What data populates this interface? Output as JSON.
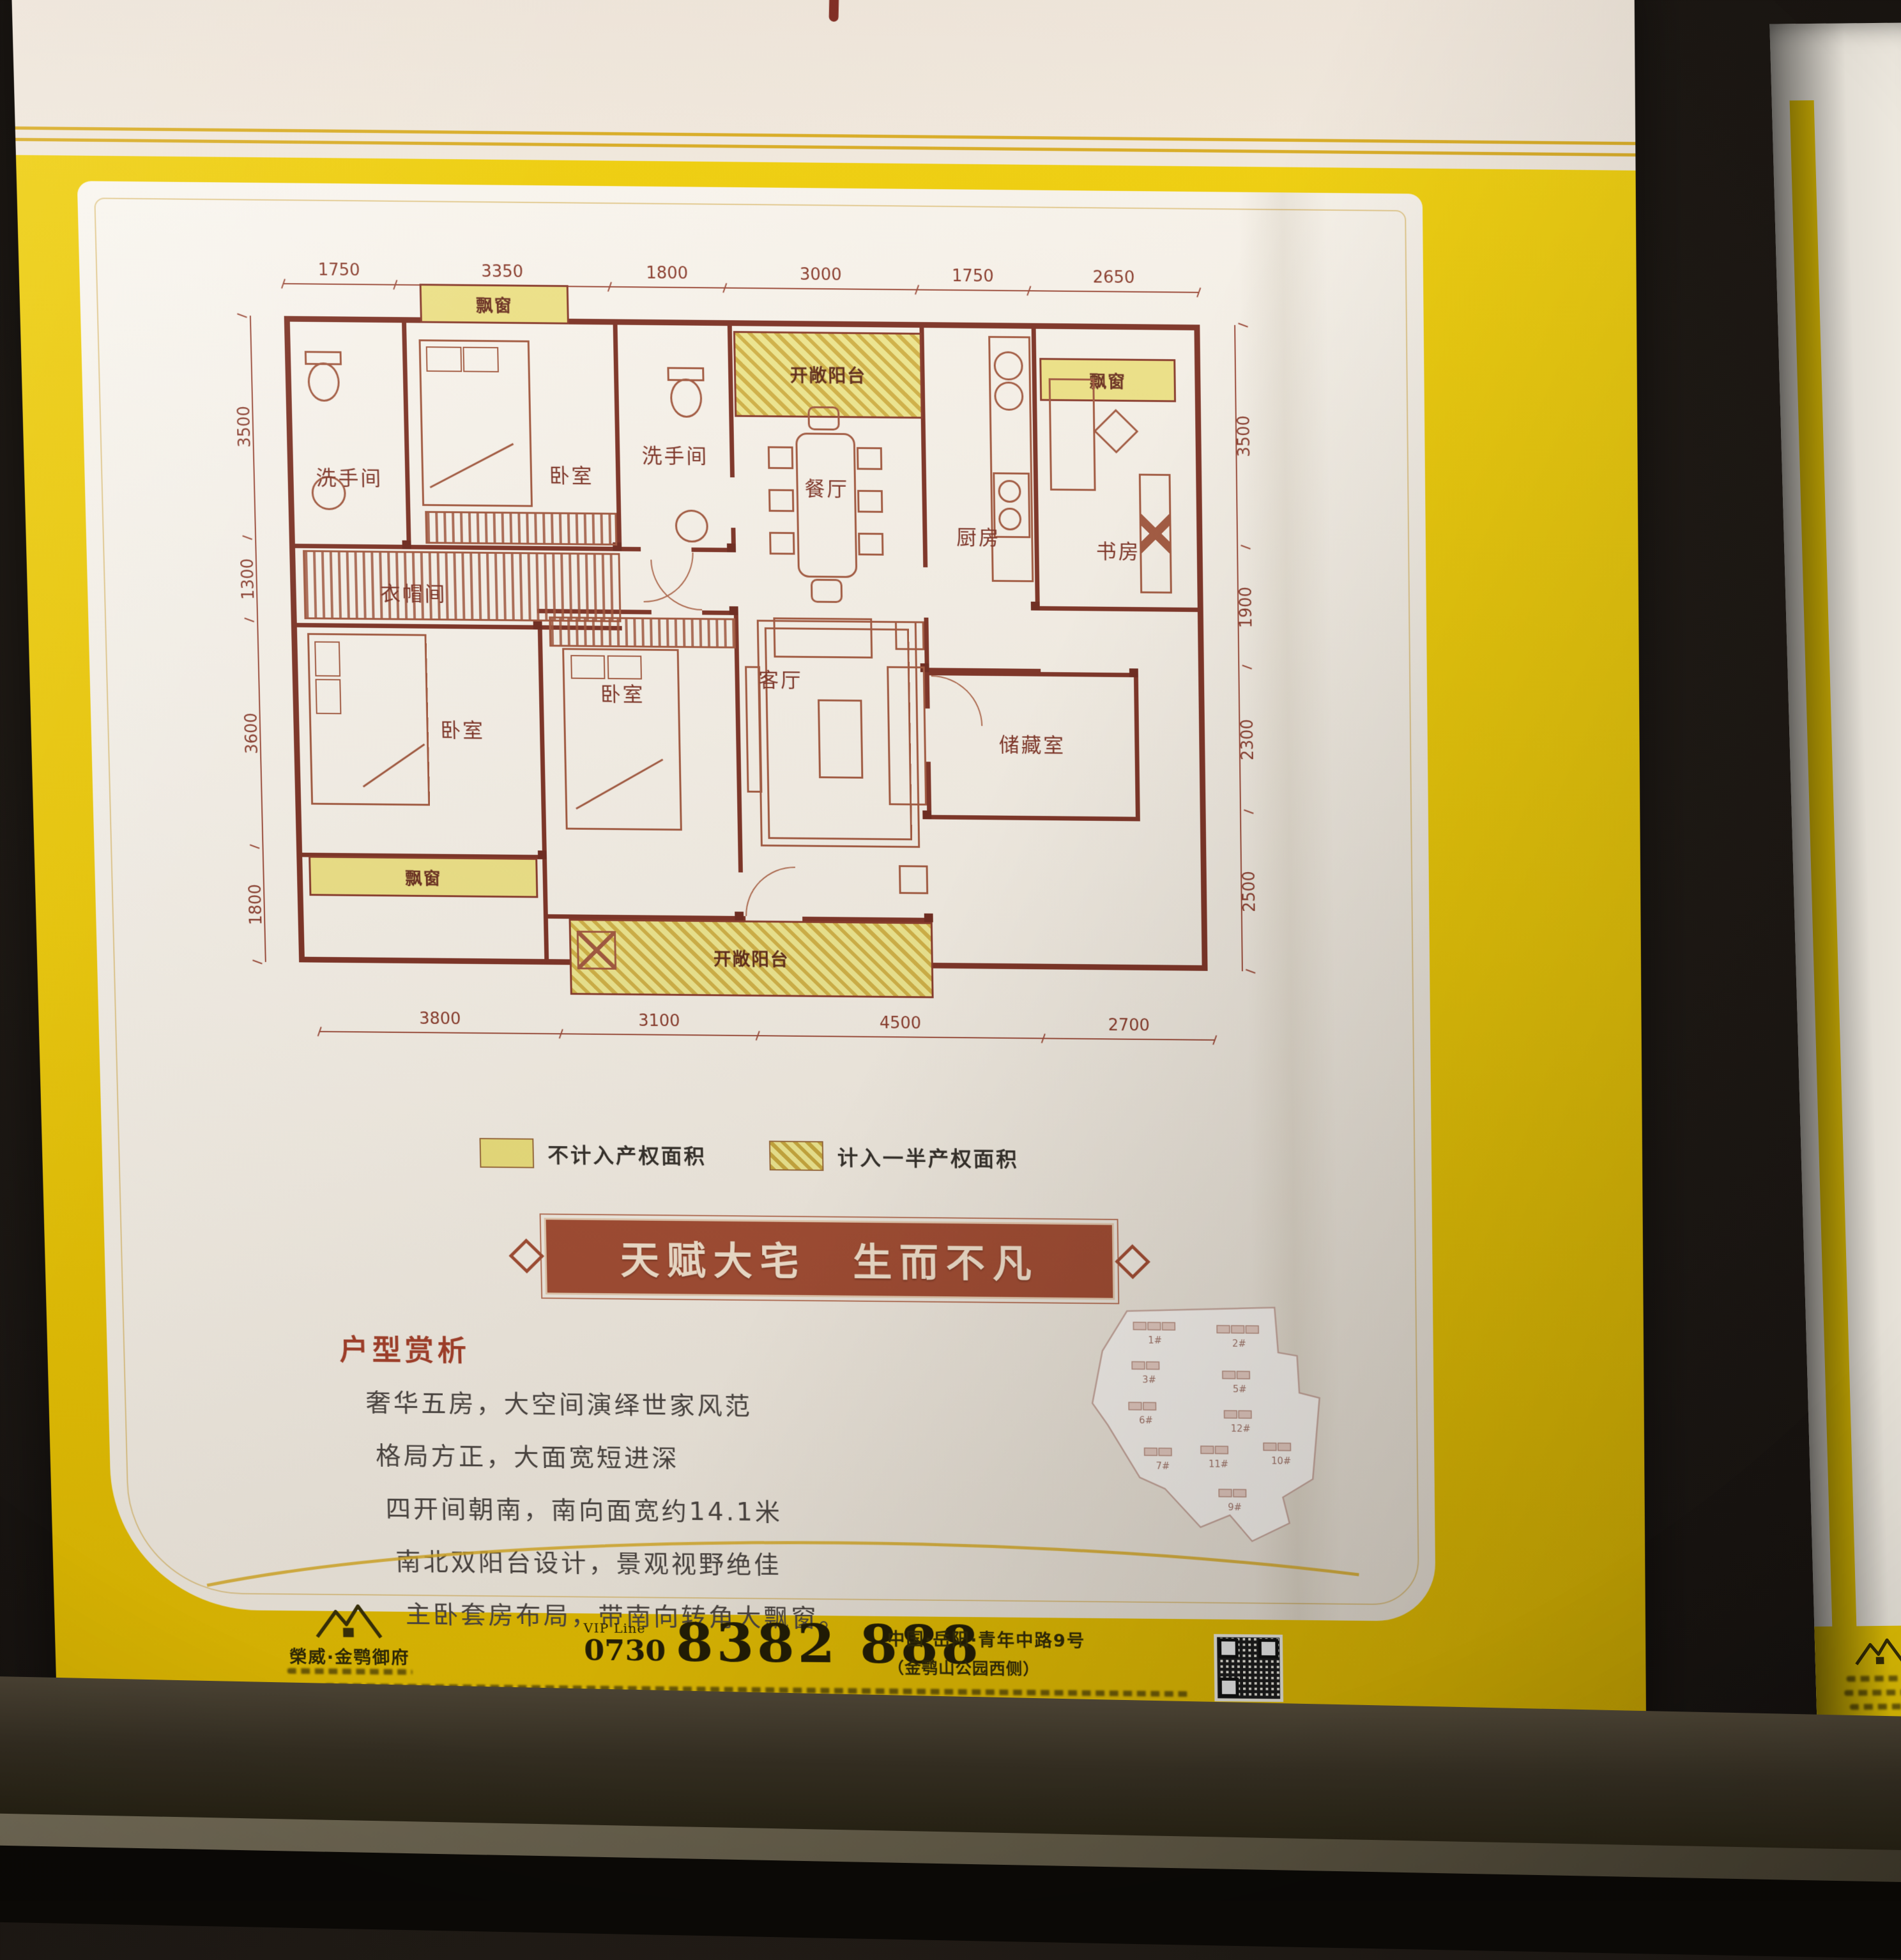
{
  "poster": {
    "legend": {
      "item1": "不计入产权面积",
      "item2": "计入一半产权面积"
    },
    "banner_text": "天赋大宅　生而不凡",
    "analysis_heading": "户型赏析",
    "analysis_lines": [
      "奢华五房，大空间演绎世家风范",
      "格局方正，大面宽短进深",
      "四开间朝南，南向面宽约14.1米",
      "南北双阳台设计，景观视野绝佳",
      "主卧套房布局，带南向转角大飘窗。"
    ],
    "floorplan": {
      "dims_top": [
        "1750",
        "3350",
        "1800",
        "3000",
        "1750",
        "2650"
      ],
      "dims_left": [
        "3500",
        "1300",
        "3600",
        "1800"
      ],
      "dims_right": [
        "3500",
        "1900",
        "2300",
        "2500"
      ],
      "dims_bottom": [
        "3800",
        "3100",
        "4500",
        "2700"
      ],
      "rooms": {
        "bath": "洗手间",
        "bedroom": "卧室",
        "dining": "餐厅",
        "kitchen": "厨房",
        "study": "书房",
        "closet": "衣帽间",
        "living": "客厅",
        "storage": "储藏室",
        "bay": "飘窗",
        "balcony": "开敞阳台"
      }
    },
    "sitemap_labels": [
      "1#",
      "2#",
      "3#",
      "5#",
      "6#",
      "12#",
      "7#",
      "11#",
      "10#",
      "9#"
    ],
    "footer": {
      "brand": "榮威·金鹗御府",
      "vip_label": "VIP Line",
      "area_code": "0730",
      "phone": "8382 888",
      "address_line1": "中国·岳阳·青年中路9号",
      "address_line2": "（金鹗山公园西侧）"
    }
  }
}
